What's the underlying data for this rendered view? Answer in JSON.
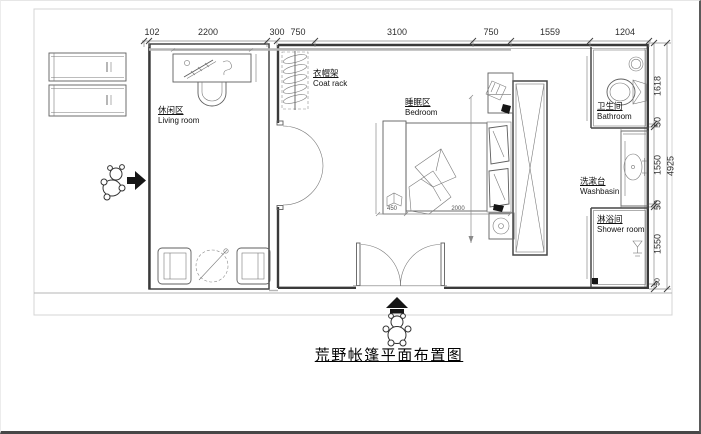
{
  "title": "荒野帐篷平面布置图",
  "top_dimensions": [
    "102",
    "2200",
    "300",
    "750",
    "3100",
    "750",
    "1559",
    "1204"
  ],
  "right_dimensions": [
    "1618",
    "50",
    "1550",
    "50",
    "1550",
    "50"
  ],
  "right_overall": "4925",
  "furniture_dimensions": {
    "nightstand_width": "450",
    "bed_length": "2000"
  },
  "rooms": {
    "living": {
      "zh": "休闲区",
      "en": "Living room"
    },
    "coat_rack": {
      "zh": "衣帽架",
      "en": "Coat rack"
    },
    "bedroom": {
      "zh": "睡眠区",
      "en": "Bedroom"
    },
    "bathroom": {
      "zh": "卫生间",
      "en": "Bathroom"
    },
    "washbasin": {
      "zh": "洗漱台",
      "en": "Washbasin"
    },
    "shower": {
      "zh": "淋浴间",
      "en": "Shower room"
    }
  },
  "icons": {
    "entrance_arrow": "right-arrow",
    "main_entrance_arrow": "up-arrow",
    "toilet": "toilet",
    "sink": "washbasin-sink",
    "shower_head": "shower-head",
    "floor_drain": "floor-drain",
    "coat_rack": "coat-hangers",
    "person": "person-figure"
  },
  "colors": {
    "wall": "#3a3a3a",
    "dimension": "#555555",
    "frame": "#cfcfcf",
    "arrow": "#111111",
    "background": "#ffffff"
  }
}
